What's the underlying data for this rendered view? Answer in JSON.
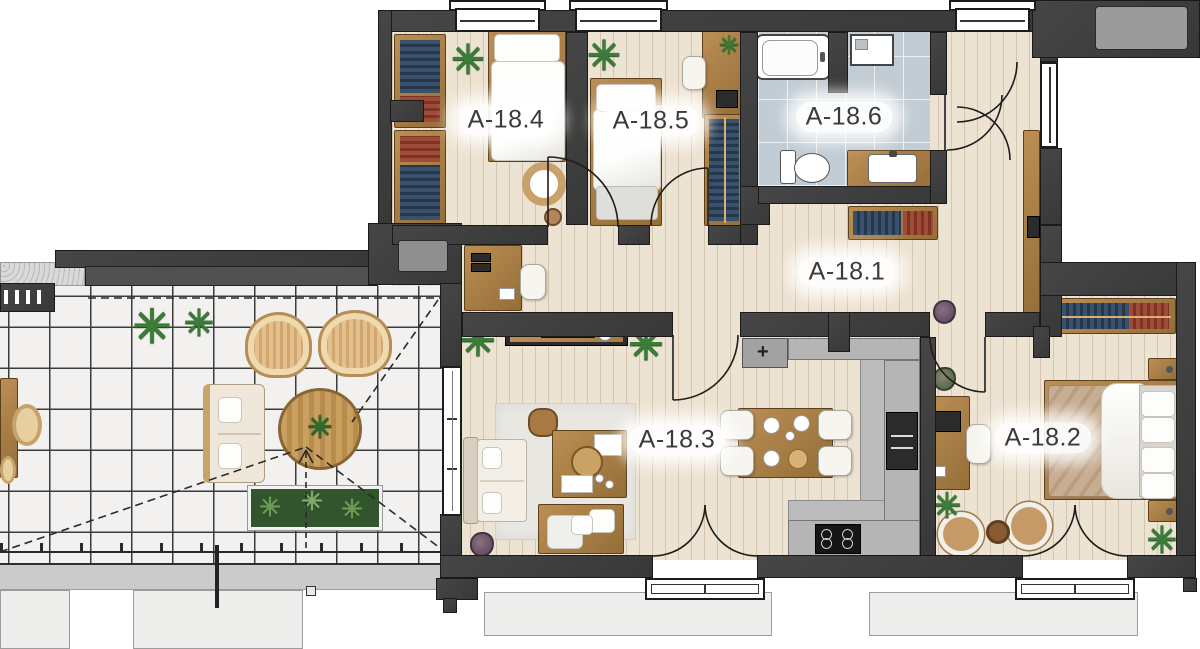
{
  "plan": {
    "name": "apartment-floor-plan",
    "unit_prefix": "A-18",
    "rooms": [
      {
        "id": "a-18-1",
        "label": "A-18.1",
        "type": "hallway"
      },
      {
        "id": "a-18-2",
        "label": "A-18.2",
        "type": "bedroom"
      },
      {
        "id": "a-18-3",
        "label": "A-18.3",
        "type": "living-room"
      },
      {
        "id": "a-18-4",
        "label": "A-18.4",
        "type": "bedroom"
      },
      {
        "id": "a-18-5",
        "label": "A-18.5",
        "type": "bedroom"
      },
      {
        "id": "a-18-6",
        "label": "A-18.6",
        "type": "bathroom"
      }
    ],
    "icons": {
      "plant": "✳",
      "faucet": "+"
    },
    "colors": {
      "wall": "#3f3f3f",
      "wood_floor": "#ede3d2",
      "bathroom_tile": "#c2ccd4",
      "terrace_tile": "#f2f1ef",
      "kitchen_counter": "#b5b5b5",
      "furniture_wood": "#a97c45",
      "clothes_blue": "#3a516b",
      "clothes_red": "#a04a38",
      "label_text": "#3a3a3a"
    }
  }
}
